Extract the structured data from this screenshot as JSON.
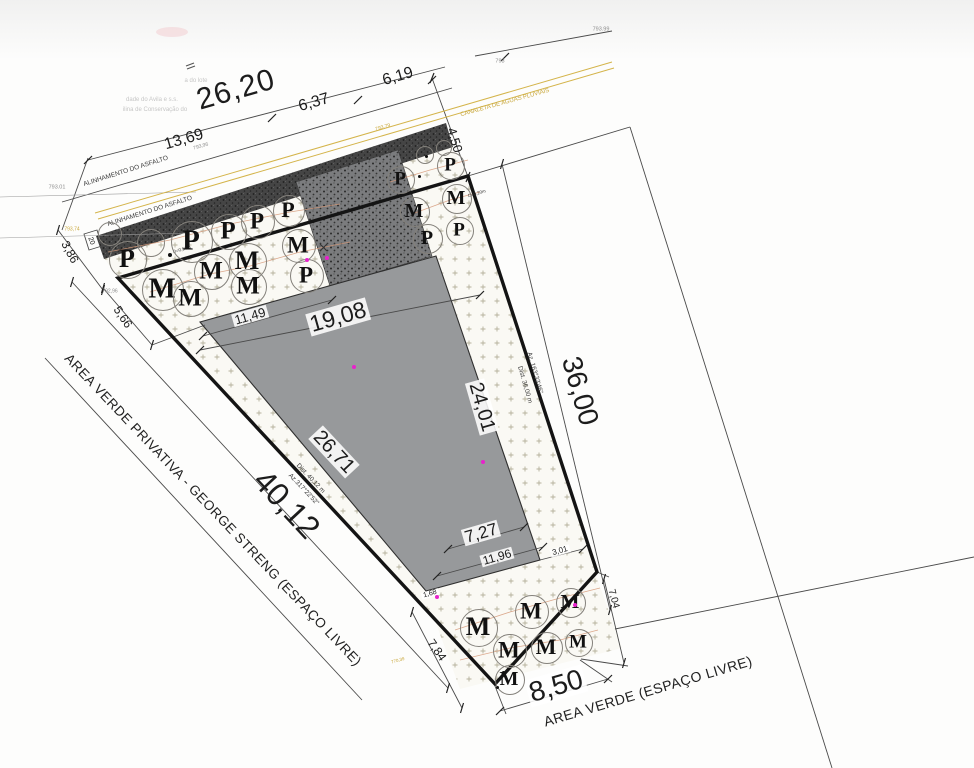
{
  "drawing": {
    "type": "site-plan",
    "language": "pt-BR",
    "colors": {
      "boundary": "#141414",
      "building_fill": "#97999b",
      "asphalt": "#3f3f3f",
      "driveway": "#77787a",
      "stipple_mark": "#b5b19c",
      "tree_line": "#d69a7a",
      "canaleta_yellow": "#c9a83d",
      "survey_point_magenta": "#e822cc"
    }
  },
  "labels": [
    {
      "name": "dim-26-20",
      "text": "26,20",
      "x": 236,
      "y": 90,
      "rot": -16,
      "size": 30,
      "cls": "big"
    },
    {
      "name": "dim-6-37",
      "text": "6,37",
      "x": 314,
      "y": 103,
      "rot": -16,
      "size": 16,
      "cls": ""
    },
    {
      "name": "dim-6-19",
      "text": "6,19",
      "x": 398,
      "y": 77,
      "rot": -16,
      "size": 16,
      "cls": ""
    },
    {
      "name": "dim-13-69",
      "text": "13,69",
      "x": 184,
      "y": 140,
      "rot": -16,
      "size": 16,
      "cls": ""
    },
    {
      "name": "dim-4-50",
      "text": "4,50",
      "x": 455,
      "y": 140,
      "rot": 73,
      "size": 13,
      "cls": ""
    },
    {
      "name": "dim-3-86",
      "text": "3,86",
      "x": 70,
      "y": 252,
      "rot": 62,
      "size": 12,
      "cls": ""
    },
    {
      "name": "dim-5-66",
      "text": "5,66",
      "x": 123,
      "y": 317,
      "rot": 56,
      "size": 12,
      "cls": ""
    },
    {
      "name": "dim-11-49",
      "text": "11,49",
      "x": 250,
      "y": 316,
      "rot": -16,
      "size": 13,
      "cls": "halo"
    },
    {
      "name": "dim-19-08",
      "text": "19,08",
      "x": 338,
      "y": 317,
      "rot": -16,
      "size": 23,
      "cls": "halo"
    },
    {
      "name": "dim-26-71",
      "text": "26,71",
      "x": 334,
      "y": 452,
      "rot": 47,
      "size": 20,
      "cls": "halo"
    },
    {
      "name": "dim-24-01",
      "text": "24,01",
      "x": 482,
      "y": 407,
      "rot": 74,
      "size": 20,
      "cls": "halo"
    },
    {
      "name": "dim-36-00",
      "text": "36,00",
      "x": 580,
      "y": 391,
      "rot": 74,
      "size": 28,
      "cls": ""
    },
    {
      "name": "dim-40-12",
      "text": "40,12",
      "x": 287,
      "y": 504,
      "rot": 47,
      "size": 32,
      "cls": ""
    },
    {
      "name": "dim-7-27",
      "text": "7,27",
      "x": 481,
      "y": 533,
      "rot": -16,
      "size": 17,
      "cls": "halo"
    },
    {
      "name": "dim-11-96",
      "text": "11,96",
      "x": 497,
      "y": 557,
      "rot": -16,
      "size": 12,
      "cls": "halo"
    },
    {
      "name": "dim-3-01",
      "text": "3,01",
      "x": 560,
      "y": 551,
      "rot": -16,
      "size": 8,
      "cls": "halo"
    },
    {
      "name": "dim-7-04",
      "text": "7,04",
      "x": 613,
      "y": 599,
      "rot": 75,
      "size": 10,
      "cls": ""
    },
    {
      "name": "dim-7-84",
      "text": "7,84",
      "x": 437,
      "y": 650,
      "rot": 55,
      "size": 12,
      "cls": ""
    },
    {
      "name": "dim-8-50",
      "text": "8,50",
      "x": 556,
      "y": 686,
      "rot": -16,
      "size": 28,
      "cls": "halo"
    },
    {
      "name": "dim-1-68",
      "text": "1,68",
      "x": 430,
      "y": 594,
      "rot": -16,
      "size": 7,
      "cls": "halo"
    },
    {
      "name": "dim-20",
      "text": "20",
      "x": 91,
      "y": 241,
      "rot": 70,
      "size": 7,
      "cls": ""
    },
    {
      "name": "label-area-verde-privativa",
      "text": "AREA VERDE PRIVATIVA - GEORGE STRENG (ESPAÇO LIVRE)",
      "x": 213,
      "y": 510,
      "rot": 46.5,
      "size": 13.5,
      "cls": "area"
    },
    {
      "name": "label-area-verde",
      "text": "AREA VERDE (ESPAÇO LIVRE)",
      "x": 648,
      "y": 691,
      "rot": -16.5,
      "size": 14,
      "cls": "area"
    },
    {
      "name": "label-alinhamento-asfalto-1",
      "text": "ALINHAMENTO DO ASFALTO",
      "x": 126,
      "y": 172,
      "rot": -17.5,
      "size": 6.5,
      "cls": "gray3"
    },
    {
      "name": "label-alinhamento-asfalto-2",
      "text": "ALINHAMENTO DO ASFALTO",
      "x": 150,
      "y": 212,
      "rot": -17.5,
      "size": 6.5,
      "cls": "gray3"
    },
    {
      "name": "label-canaleta",
      "text": "CANALETA DE AGUAS PLUVIAIS",
      "x": 505,
      "y": 103,
      "rot": -15.5,
      "size": 6,
      "cls": "yellow"
    },
    {
      "name": "elev-793-79",
      "text": "793,79",
      "x": 383,
      "y": 128,
      "rot": -16,
      "size": 5,
      "cls": "yellow"
    },
    {
      "name": "elev-793-74",
      "text": "793,74",
      "x": 72,
      "y": 230,
      "rot": 0,
      "size": 5,
      "cls": "yellow"
    },
    {
      "name": "elev-770-39",
      "text": "770,39",
      "x": 398,
      "y": 661,
      "rot": -16,
      "size": 4.5,
      "cls": "yellow"
    },
    {
      "name": "elev-793-01",
      "text": "793.01",
      "x": 57,
      "y": 188,
      "rot": 0,
      "size": 5.5,
      "cls": "gray6"
    },
    {
      "name": "elev-793-99",
      "text": "793.99",
      "x": 601,
      "y": 30,
      "rot": 0,
      "size": 5.5,
      "cls": "gray6"
    },
    {
      "name": "elev-793",
      "text": "793",
      "x": 500,
      "y": 62,
      "rot": 0,
      "size": 5.5,
      "cls": "gray6"
    },
    {
      "name": "elev-793-96",
      "text": "793,96",
      "x": 201,
      "y": 147,
      "rot": -16,
      "size": 5,
      "cls": "gray6"
    },
    {
      "name": "elev-792-96",
      "text": "792,96",
      "x": 110,
      "y": 292,
      "rot": 0,
      "size": 5,
      "cls": "gray6"
    },
    {
      "name": "azimuth-right-line1",
      "text": "Az. 163°33'46\"",
      "x": 534,
      "y": 373,
      "rot": 74,
      "size": 6.5,
      "cls": "gray3"
    },
    {
      "name": "azimuth-right-line2",
      "text": "Dist. 36,00 m",
      "x": 524,
      "y": 385,
      "rot": 74,
      "size": 6.5,
      "cls": "gray3"
    },
    {
      "name": "azimuth-left-line1",
      "text": "Dist. 40,12 m",
      "x": 310,
      "y": 479,
      "rot": 46.5,
      "size": 6.5,
      "cls": "gray3"
    },
    {
      "name": "azimuth-left-line2",
      "text": "Az.317°22'52\"",
      "x": 303,
      "y": 490,
      "rot": 46.5,
      "size": 6.5,
      "cls": "gray3"
    },
    {
      "name": "tree-diameter-050",
      "text": "D=0,50m",
      "x": 182,
      "y": 250,
      "rot": -16,
      "size": 4.5,
      "cls": "gray3"
    },
    {
      "name": "tree-diameter-020a",
      "text": "D=0,20m",
      "x": 432,
      "y": 150,
      "rot": -16,
      "size": 4.5,
      "cls": "gray3"
    },
    {
      "name": "tree-diameter-020b",
      "text": "D=0,20m",
      "x": 477,
      "y": 194,
      "rot": -16,
      "size": 4.5,
      "cls": "gray3"
    },
    {
      "name": "ghost-text-1",
      "text": "a do lote",
      "x": 196,
      "y": 81,
      "rot": 0,
      "size": 6,
      "cls": "faint"
    },
    {
      "name": "ghost-text-2",
      "text": "dade do Avila e s.s.",
      "x": 152,
      "y": 100,
      "rot": 0,
      "size": 6,
      "cls": "faint"
    },
    {
      "name": "ghost-text-3",
      "text": "ilina de Conservação do",
      "x": 155,
      "y": 110,
      "rot": 0,
      "size": 6,
      "cls": "faint"
    }
  ],
  "trees": [
    {
      "x": 127,
      "y": 259,
      "r": 18,
      "letter": "P"
    },
    {
      "x": 191,
      "y": 241,
      "r": 20,
      "letter": "P"
    },
    {
      "x": 228,
      "y": 231,
      "r": 17,
      "letter": "P"
    },
    {
      "x": 257,
      "y": 221,
      "r": 16,
      "letter": "P"
    },
    {
      "x": 288,
      "y": 210,
      "r": 15,
      "letter": "P"
    },
    {
      "x": 162,
      "y": 289,
      "r": 20,
      "letter": "M"
    },
    {
      "x": 190,
      "y": 298,
      "r": 17,
      "letter": "M"
    },
    {
      "x": 211,
      "y": 271,
      "r": 17,
      "letter": "M"
    },
    {
      "x": 247,
      "y": 261,
      "r": 18,
      "letter": "M"
    },
    {
      "x": 248,
      "y": 286,
      "r": 17,
      "letter": "M"
    },
    {
      "x": 298,
      "y": 245,
      "r": 16,
      "letter": "M"
    },
    {
      "x": 306,
      "y": 275,
      "r": 16,
      "letter": "P"
    },
    {
      "x": 150,
      "y": 242,
      "r": 13,
      "letter": ""
    },
    {
      "x": 109,
      "y": 233,
      "r": 11,
      "letter": ""
    },
    {
      "x": 400,
      "y": 179,
      "r": 13,
      "letter": "P"
    },
    {
      "x": 450,
      "y": 165,
      "r": 13,
      "letter": "P"
    },
    {
      "x": 456,
      "y": 198,
      "r": 14,
      "letter": "M"
    },
    {
      "x": 414,
      "y": 211,
      "r": 14,
      "letter": "M"
    },
    {
      "x": 427,
      "y": 238,
      "r": 14,
      "letter": "P"
    },
    {
      "x": 459,
      "y": 230,
      "r": 13,
      "letter": "P"
    },
    {
      "x": 424,
      "y": 154,
      "r": 8,
      "letter": ""
    },
    {
      "x": 443,
      "y": 147,
      "r": 7,
      "letter": ""
    },
    {
      "x": 478,
      "y": 627,
      "r": 18,
      "letter": "M"
    },
    {
      "x": 531,
      "y": 611,
      "r": 16,
      "letter": "M"
    },
    {
      "x": 570,
      "y": 602,
      "r": 14,
      "letter": "M"
    },
    {
      "x": 509,
      "y": 650,
      "r": 16,
      "letter": "M"
    },
    {
      "x": 546,
      "y": 647,
      "r": 15,
      "letter": "M"
    },
    {
      "x": 578,
      "y": 642,
      "r": 13,
      "letter": "M"
    },
    {
      "x": 509,
      "y": 679,
      "r": 14,
      "letter": "M"
    }
  ],
  "dots": [
    {
      "x": 307,
      "y": 260,
      "color": "#e822cc",
      "size": 4
    },
    {
      "x": 327,
      "y": 258,
      "color": "#e822cc",
      "size": 4
    },
    {
      "x": 354,
      "y": 367,
      "color": "#e822cc",
      "size": 4
    },
    {
      "x": 483,
      "y": 462,
      "color": "#e822cc",
      "size": 4
    },
    {
      "x": 437,
      "y": 597,
      "color": "#e822cc",
      "size": 4
    },
    {
      "x": 575,
      "y": 605,
      "color": "#e822cc",
      "size": 4
    },
    {
      "x": 170,
      "y": 255,
      "color": "#111111",
      "size": 4
    },
    {
      "x": 426,
      "y": 156,
      "color": "#111111",
      "size": 3
    },
    {
      "x": 419,
      "y": 176,
      "color": "#111111",
      "size": 3
    },
    {
      "x": 503,
      "y": 672,
      "color": "#111111",
      "size": 3
    },
    {
      "x": 497,
      "y": 687,
      "color": "#111111",
      "size": 3
    }
  ]
}
